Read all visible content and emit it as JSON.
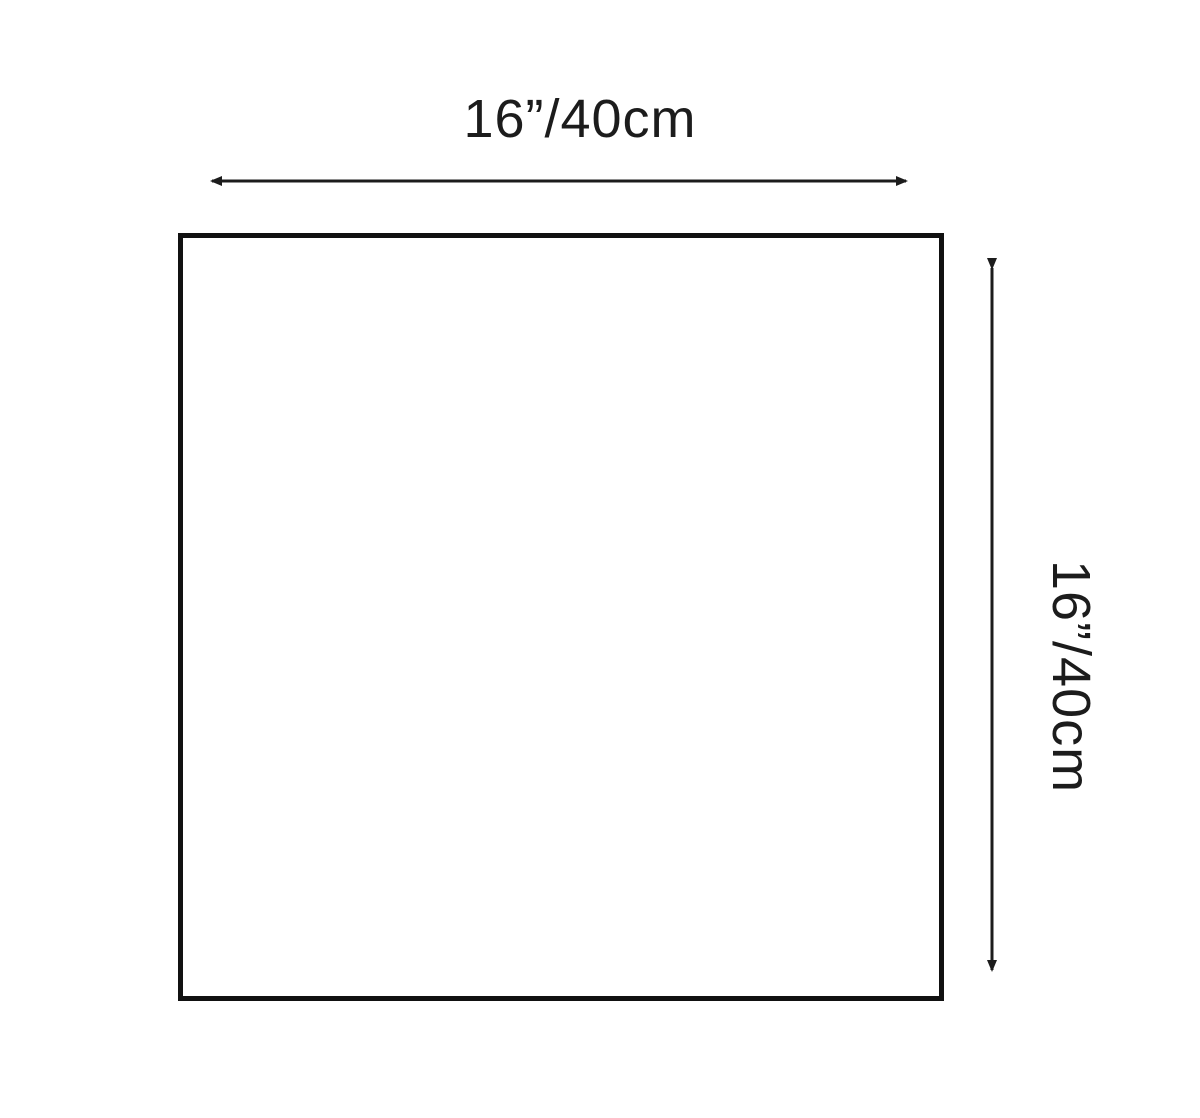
{
  "diagram": {
    "shape": "square",
    "dimensions": {
      "width_label": "16”/40cm",
      "height_label": "16”/40cm"
    },
    "colors": {
      "line": "#1c1c1c",
      "outline": "#111111",
      "background": "#ffffff"
    }
  }
}
